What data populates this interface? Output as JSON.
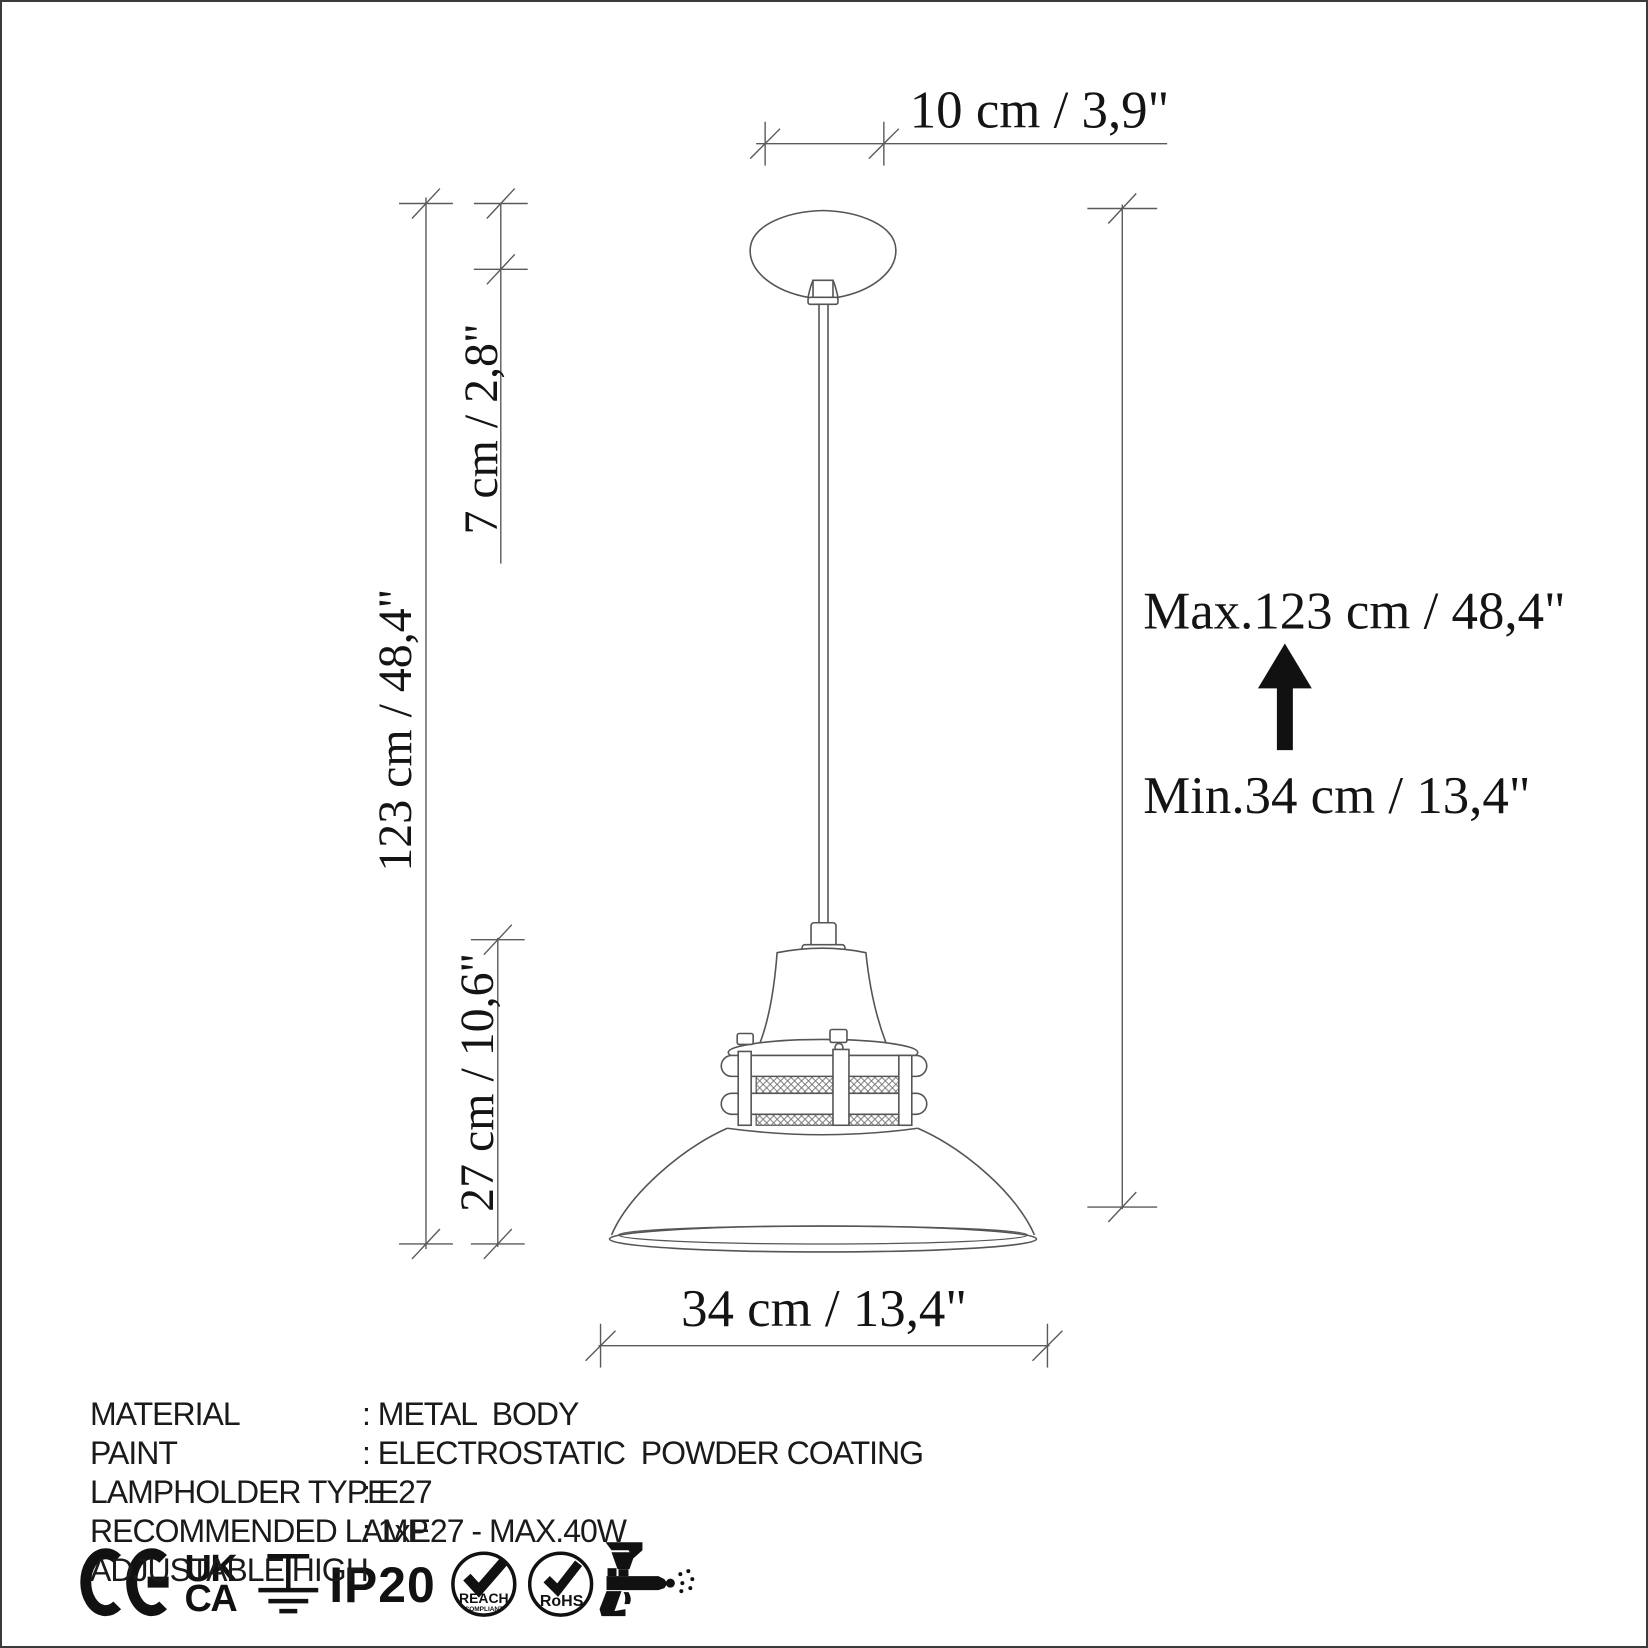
{
  "page": {
    "background": "#ffffff",
    "border_color": "#3b3b3b",
    "line_color": "#555555",
    "text_color": "#141414"
  },
  "dimensions": {
    "canopy_width": "10 cm / 3,9\"",
    "canopy_height": "7 cm / 2,8\"",
    "hanging_height": "123 cm / 48,4\"",
    "fixture_height": "27 cm / 10,6\"",
    "shade_diameter": "34 cm / 13,4\"",
    "max_height": "Max.123 cm / 48,4\"",
    "min_height": "Min.34 cm / 13,4\""
  },
  "specifications": [
    {
      "label": "MATERIAL",
      "value": ": METAL  BODY"
    },
    {
      "label": "PAINT",
      "value": ": ELECTROSTATIC  POWDER COATING"
    },
    {
      "label": "LAMPHOLDER TYPE",
      "value": ": E27"
    },
    {
      "label": "RECOMMENDED LAMP",
      "value": ": 1xE27 - MAX.40W"
    },
    {
      "label": "ADJUSTABLE HIGH",
      "value": ""
    }
  ],
  "certifications": {
    "ukca_line1": "UK",
    "ukca_line2": "CA",
    "ip_rating": "IP20",
    "reach_label": "REACH",
    "reach_sublabel": "COMPLIANT",
    "rohs_label": "RoHS"
  }
}
